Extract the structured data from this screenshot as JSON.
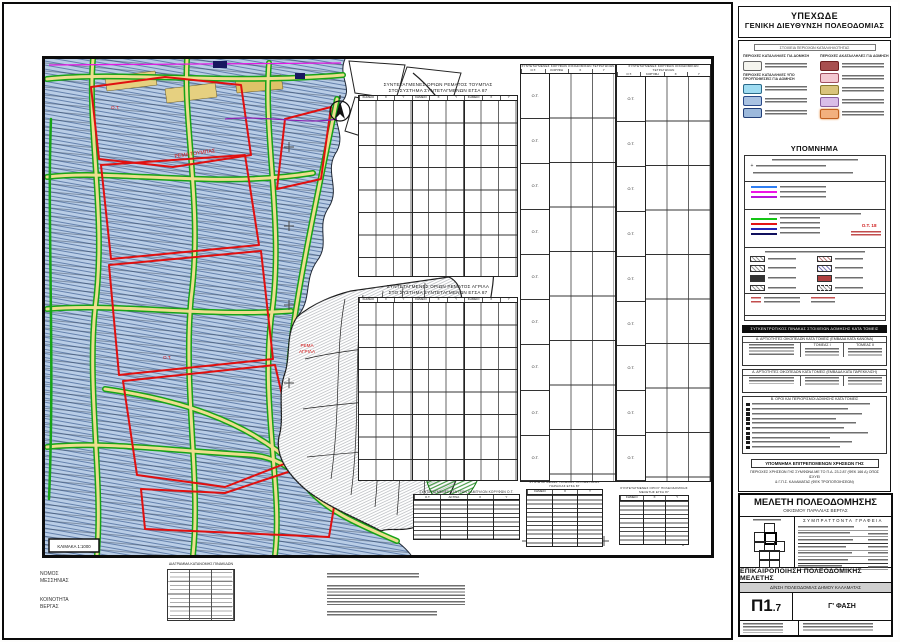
{
  "sheet": {
    "agency_line1": "ΥΠΕΧΩΔΕ",
    "agency_line2": "ΓΕΝΙΚΗ ΔΙΕΥΘΥΝΣΗ ΠΟΛΕΟΔΟΜΙΑΣ"
  },
  "legend": {
    "data_title": "ΣΤΟΙΧΕΙΑ ΠΕΡΙΟΧΩΝ ΚΑΤΑΛΛΗΛΟΤΗΤΑΣ",
    "suitable_header": "ΠΕΡΙΟΧΕΣ ΚΑΤΑΛΛΗΛΕΣ ΓΙΑ ΔΟΜΗΣΗ",
    "conditional_header": "ΠΕΡΙΟΧΕΣ ΚΑΤΑΛΛΗΛΕΣ ΥΠΟ ΠΡΟΫΠΟΘΕΣΕΙΣ ΓΙΑ ΔΟΜΗΣΗ",
    "unsuitable_header": "ΠΕΡΙΟΧΕΣ ΑΚΑΤΑΛΛΗΛΕΣ ΓΙΑ ΔΟΜΗΣΗ",
    "hypomnema_title": "ΥΠΟΜΝΗΜΑ",
    "ot_sample": "Ο.Τ. 18",
    "summary_strip": "ΣΥΓΚΕΝΤΡΩΤΙΚΟΣ ΠΙΝΑΚΑΣ ΣΤΟΙΧΕΙΩΝ ΔΟΜΗΣΗΣ ΚΑΤΑ ΤΟΜΕΙΣ",
    "table_a_title": "Α. ΑΡΤΙΟΤΗΤΕΣ ΟΙΚΟΠΕΔΩΝ ΚΑΤΑ ΤΟΜΕΙΣ (ΕΜΒΑΔΑ ΚΑΤΑ ΚΑΝΟΝΑ)",
    "table_b_title": "Α. ΑΡΤΙΟΤΗΤΕΣ ΟΙΚΟΠΕΔΩΝ ΚΑΤΑ ΤΟΜΕΙΣ (ΕΜΒΑΔΑ ΚΑΤΑ ΠΑΡΕΚΚΛΙΣΗ)",
    "sector_1": "ΤΟΜΕΑΣ Ι",
    "sector_2": "ΤΟΜΕΑΣ ΙΙ",
    "list_title": "Β. ΟΡΟΙ ΚΑΙ ΠΕΡΙΟΡΙΣΜΟΙ ΔΟΜΗΣΗΣ ΚΑΤΑ ΤΟΜΕΙΣ",
    "uses_title": "ΥΠΟΜΝΗΜΑ ΕΠΙΤΡΕΠΟΜΕΝΩΝ ΧΡΗΣΕΩΝ ΓΗΣ",
    "uses_line1": "ΠΕΡΙΟΧΕΣ ΧΡΗΣΕΩΝ ΓΗΣ ΣΥΜΦΩΝΑ ΜΕ ΤΟ Π.Δ. 23.2.87 (ΦΕΚ 166 Δ) ΟΠΩΣ ΙΣΧΥΕΙ",
    "uses_line2": "& Γ.Π.Σ. ΚΑΛΑΜΑΤΑΣ (ΦΕΚ ΤΡΟΠΟΠΟΙΗΣΕΩΝ)"
  },
  "map": {
    "scale_label": "ΚΛΙΜΑΚΑ 1:1000",
    "label_stream_north": "ΡΕΜΑ ΤΟΥΜΠΑΣ",
    "label_stream_south_1": "ΡΕΜΑ",
    "label_stream_south_2": "ΑΓΡΙΛΑ",
    "label_block_a": "Ο.Τ.",
    "label_block_b": "Ο.Τ."
  },
  "tables": {
    "toumpas_title": "ΣΥΝΤΕΤΑΓΜΕΝΕΣ ΟΡΙΩΝ ΡΕΜΑΤΟΣ ΤΟΥΜΠΑΣ",
    "agrila_title": "ΣΥΝΤΕΤΑΓΜΕΝΕΣ ΟΡΙΩΝ ΡΕΜΑΤΟΣ ΑΓΡΙΛΑ",
    "system_subtitle": "ΣΤΟ ΣΥΣΤΗΜΑ ΣΥΝΤΕΤΑΓΜΕΝΩΝ ΕΓΣΑ 87",
    "ot_columns_title": "ΣΥΝΤΕΤΑΓΜΕΝΕΣ ΚΟΡΥΦΩΝ ΟΙΚΟΔΟΜΙΚΩΝ ΤΕΤΡΑΓΩΝΩΝ",
    "curves_title": "ΣΥΝΤΕΤΑΓΜΕΝΕΣ ΚΕΝΤΡΩΝ ΚΑΜΠΥΛΩΝ ΚΟΡΥΦΩΝ Ο.Τ.",
    "shoreline_title_1": "ΣΥΝΤΕΤΑΓΜΕΝΕΣ ΓΡΑΜΜΗΣ ΟΡΙΟΘΕΤΗΣΗΣ",
    "shoreline_title_2": "ΠΑΡΑΛΙΑΣ ΕΓΣΑ 87",
    "boundary_title_1": "ΣΥΝΤΕΤΑΓΜΕΝΕΣ ΟΡΙΟΥ ΠΟΛΕΟΔΟΜΙΚΗΣ",
    "boundary_title_2": "ΜΕΛΕΤΗΣ ΕΓΣΑ 87",
    "col_point": "ΣΗΜΕΙΟ",
    "col_x": "Χ",
    "col_y": "Υ",
    "col_ot": "Ο.Τ.",
    "col_vertex": "ΚΟΡΥΦΗ",
    "col_radius": "ΑΚΤΙΝΑ",
    "ot_label": "Ο.Τ."
  },
  "titleblock": {
    "study": "ΜΕΛΕΤΗ ΠΟΛΕΟΔΟΜΗΣΗΣ",
    "settlement": "ΟΙΚΙΣΜΟΥ ΠΑΡΑΛΙΑΣ ΒΕΡΓΑΣ",
    "team_header": "ΣΥΜΠΡΑΤΤΟΝΤΑ ΓΡΑΦΕΙΑ",
    "update_title": "ΕΠΙΚΑΙΡΟΠΟΙΗΣΗ ΠΟΛΕΟΔΟΜΙΚΗΣ ΜΕΛΕΤΗΣ",
    "authority": "Δ/ΝΣΗ ΠΟΛΕΟΔΟΜΙΑΣ ΔΗΜΟΥ ΚΑΛΑΜΑΤΑΣ",
    "sheet_no": "Π1",
    "sheet_no_suffix": ".7",
    "phase": "Γ' ΦΑΣΗ"
  },
  "footer": {
    "prefecture_line1": "ΝΟΜΟΣ",
    "prefecture_line2": "ΜΕΣΣΗΝΙΑΣ",
    "community_line1": "ΚΟΙΝΟΤΗΤΑ",
    "community_line2": "ΒΕΡΓΑΣ",
    "grid_title": "ΔΙΑΓΡΑΜΜΑ ΚΑΤΑΝΟΜΗΣ ΠΙΝΑΚΙΔΩΝ"
  },
  "colors": {
    "block_outline_red": "#dd1111",
    "road_green": "#17a317",
    "road_yellow": "#eede8e",
    "parcel_blue": "#b9cde6",
    "line_magenta": "#e31ae3"
  }
}
